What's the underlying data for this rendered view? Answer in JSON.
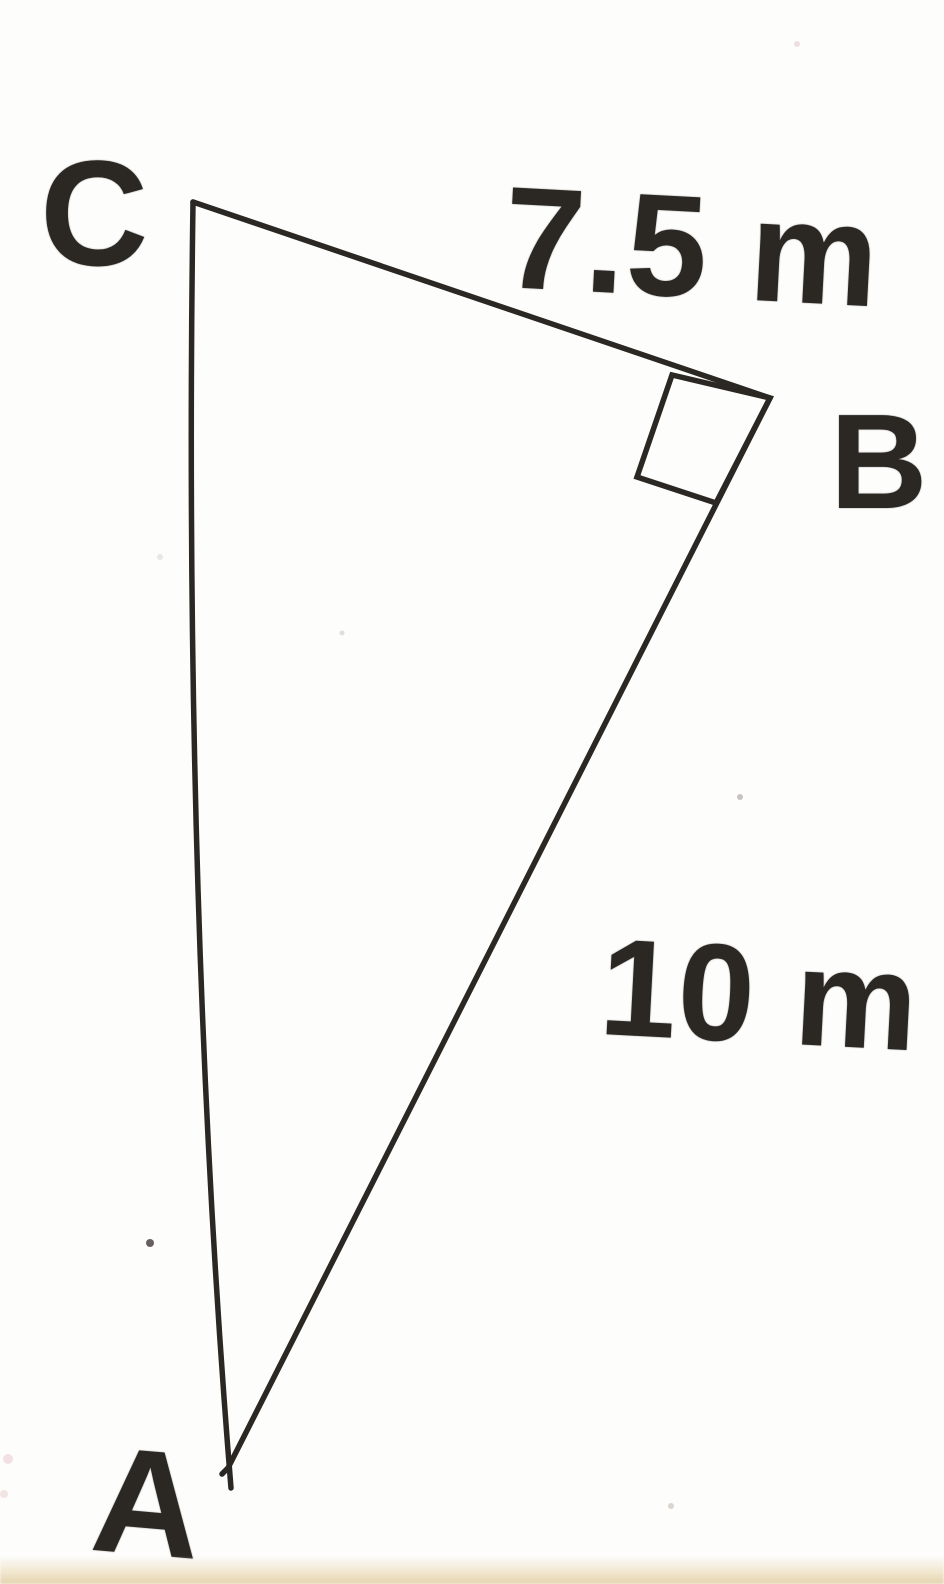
{
  "diagram": {
    "type": "right-triangle",
    "description": "Scanned hand-drawn right triangle ABC with the right angle at B",
    "unit": "m",
    "vertices": [
      {
        "id": "C",
        "label": "C",
        "x": 193,
        "y": 202
      },
      {
        "id": "B",
        "label": "B",
        "x": 770,
        "y": 398
      },
      {
        "id": "A",
        "label": "A",
        "x": 228,
        "y": 1468
      }
    ],
    "sides": [
      {
        "name": "CB",
        "from": "C",
        "to": "B",
        "measurement_label": "7.5 m",
        "value": 7.5
      },
      {
        "name": "AB",
        "from": "A",
        "to": "B",
        "measurement_label": "10 m",
        "value": 10
      },
      {
        "name": "CA",
        "from": "C",
        "to": "A",
        "measurement_label": ""
      }
    ],
    "right_angle_at": "B",
    "colors": {
      "ink": "#2b2824",
      "paper": "#fdfdfc",
      "bottom_band": "#e9dab6"
    },
    "geometry": {
      "ca_control": [
        183,
        900
      ],
      "ca_tail": [
        231,
        1488
      ],
      "ab_tail": [
        222,
        1474
      ],
      "right_angle_marker_points": "770,398 672,375 637,477 716,503",
      "specks": [
        {
          "x": 150,
          "y": 1243,
          "r": 4,
          "color": "#55504a",
          "opacity": 0.9
        },
        {
          "x": 740,
          "y": 797,
          "r": 3,
          "color": "#a59d94",
          "opacity": 0.6
        },
        {
          "x": 342,
          "y": 633,
          "r": 2.5,
          "color": "#cfc9c2",
          "opacity": 0.6
        },
        {
          "x": 160,
          "y": 557,
          "r": 3,
          "color": "#d6d2cc",
          "opacity": 0.5
        },
        {
          "x": 797,
          "y": 44,
          "r": 3,
          "color": "#dfc4c4",
          "opacity": 0.5
        },
        {
          "x": 671,
          "y": 1506,
          "r": 3,
          "color": "#b7ad9f",
          "opacity": 0.5
        },
        {
          "x": 8,
          "y": 1459,
          "r": 5,
          "color": "#e7c6c8",
          "opacity": 0.5
        },
        {
          "x": 4,
          "y": 1494,
          "r": 4,
          "color": "#e7c6c8",
          "opacity": 0.45
        }
      ]
    }
  }
}
